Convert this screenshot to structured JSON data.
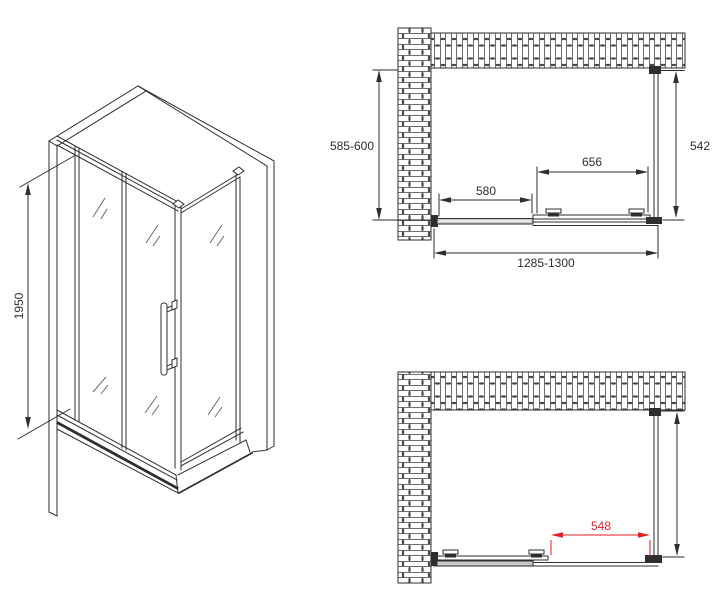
{
  "drawing": {
    "description_labels": {
      "iso_height": "1950",
      "top_view_depth": "585-600",
      "top_view_side_glass": "542",
      "top_view_door_glass": "656",
      "top_view_fixed_glass": "580",
      "top_view_overall_width": "1285-1300",
      "bottom_view_door_opening": "548"
    },
    "colors": {
      "line": "#2e2e2e",
      "dimension_red": "#e31e24",
      "profile_gray": "#c7cbcc"
    }
  }
}
